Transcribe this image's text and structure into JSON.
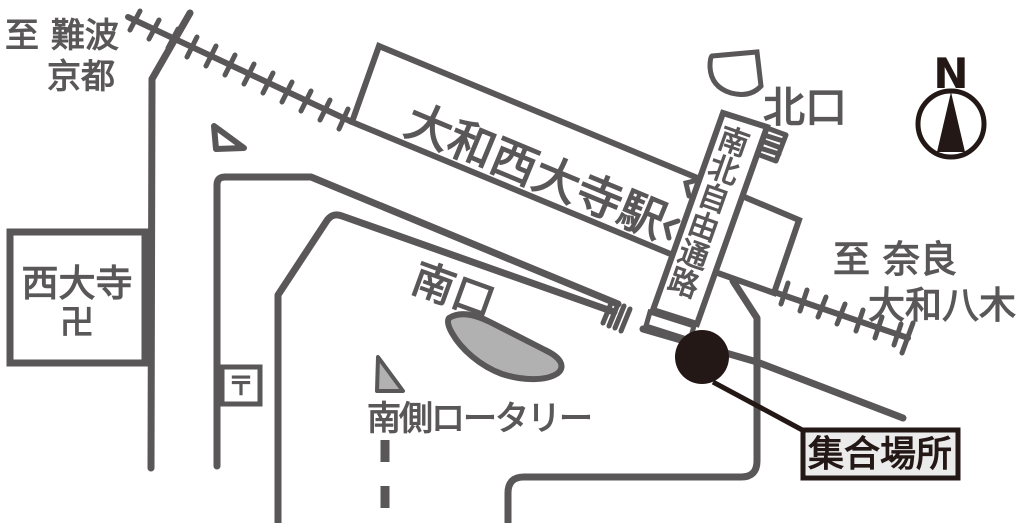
{
  "labels": {
    "destination_nw_line1": "至 難波",
    "destination_nw_line2": "京都",
    "station_name": "大和西大寺駅",
    "north_exit": "北口",
    "corridor": "南北自由通路",
    "destination_se_line1": "至 奈良",
    "destination_se_line2": "大和八木",
    "temple_name": "西大寺",
    "temple_mark": "卍",
    "south_exit": "南口",
    "post_office_mark": "〒",
    "rotary": "南側ロータリー",
    "meeting_point": "集合場所",
    "compass_north": "N"
  },
  "colors": {
    "map_line": "#595757",
    "ink": "#231815",
    "area_fill": "#b1b1b1",
    "label_bg": "#ebebeb",
    "background": "#ffffff"
  }
}
